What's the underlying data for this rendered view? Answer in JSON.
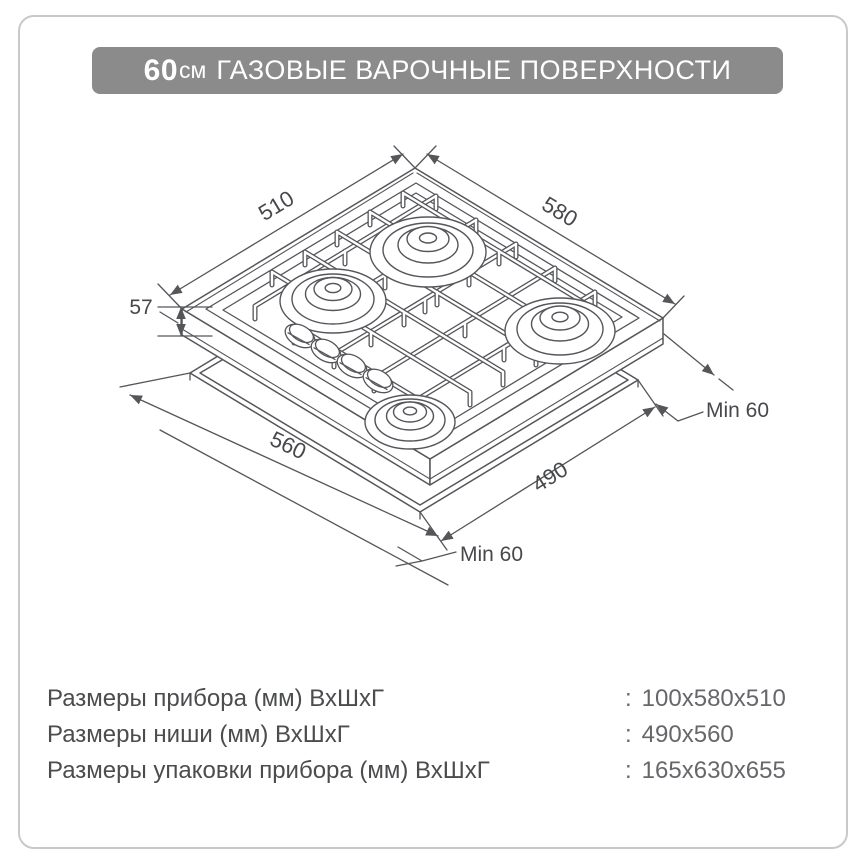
{
  "page": {
    "border_color": "#c9c9c9",
    "background": "#ffffff"
  },
  "header": {
    "size_value": "60",
    "size_unit": "см",
    "title": "ГАЗОВЫЕ ВАРОЧНЫЕ ПОВЕРХНОСТИ",
    "bg_color": "#8b8b8b",
    "text_color": "#ffffff"
  },
  "diagram": {
    "type": "isometric technical drawing",
    "subject": "built-in 4-burner gas hob above countertop cutout",
    "line_color": "#55565a",
    "dimensions": {
      "top_depth": "510",
      "top_width": "580",
      "body_height": "57",
      "niche_width": "560",
      "niche_depth": "490",
      "side_clearance": "Min 60",
      "front_clearance": "Min 60"
    }
  },
  "specs": {
    "rows": [
      {
        "label": "Размеры прибора (мм) ВхШхГ",
        "separator": ":",
        "value": "100x580x510"
      },
      {
        "label": "Размеры ниши (мм) ВхШхГ",
        "separator": ":",
        "value": "490x560"
      },
      {
        "label": "Размеры упаковки прибора (мм) ВхШхГ",
        "separator": ":",
        "value": "165x630x655"
      }
    ]
  }
}
